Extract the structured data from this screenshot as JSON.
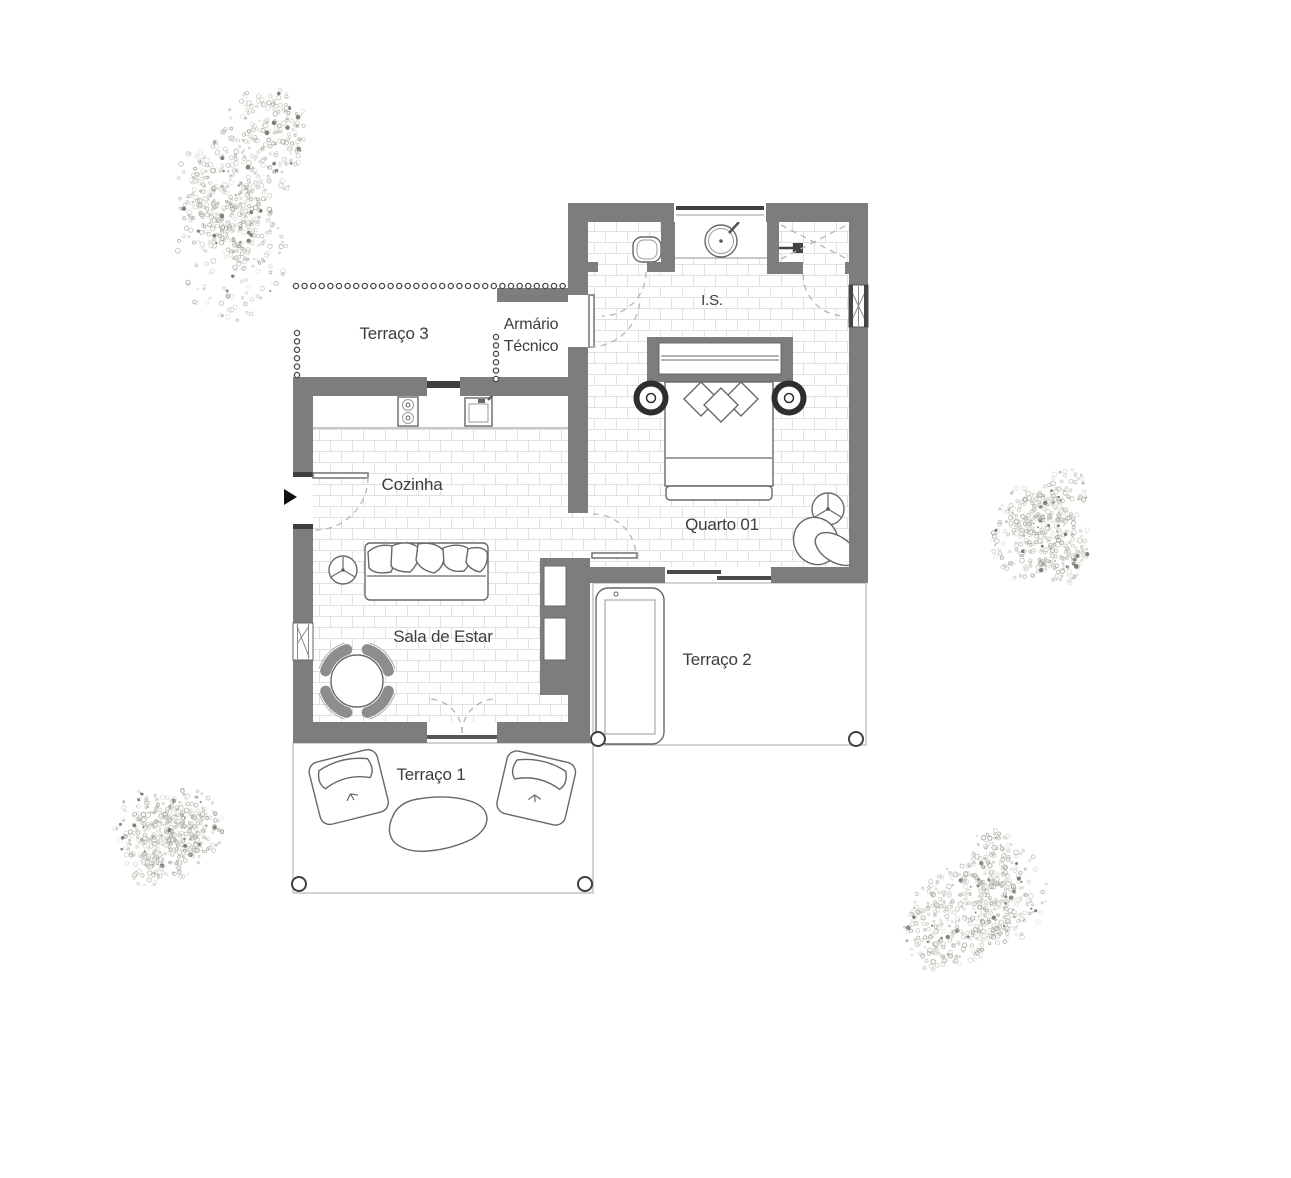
{
  "plan": {
    "type": "architectural-floor-plan",
    "labels": {
      "terraco3": "Terraço 3",
      "armario_line1": "Armário",
      "armario_line2": "Técnico",
      "is": "I.S.",
      "cozinha": "Cozinha",
      "quarto": "Quarto 01",
      "sala": "Sala de Estar",
      "terraco2": "Terraço 2",
      "terraco1": "Terraço 1"
    },
    "colors": {
      "wall": "#7d7d7d",
      "wall_dark": "#3f3f3f",
      "text": "#3d3d3d",
      "tile_brick": "#e0e0e0",
      "tile_grid": "#d2d2ce",
      "tree": "#a3a896",
      "background": "#ffffff"
    },
    "open_boundary_dots": [
      {
        "x": 296,
        "y": 286,
        "dx": 8.6,
        "dy": 0,
        "count": 32
      },
      {
        "x": 297,
        "y": 333,
        "dx": 0,
        "dy": 8.4,
        "count": 6
      },
      {
        "x": 496,
        "y": 337,
        "dx": 0,
        "dy": 8.4,
        "count": 6
      }
    ],
    "vegetation": [
      {
        "name": "tree-top-left",
        "cx": 230,
        "cy": 198,
        "r": 92,
        "stretch_y": 1.3,
        "seed": 11
      },
      {
        "name": "tree-mid-right",
        "cx": 1036,
        "cy": 537,
        "r": 60,
        "stretch_y": 1.15,
        "seed": 22
      },
      {
        "name": "tree-bottom-left",
        "cx": 173,
        "cy": 820,
        "r": 60,
        "stretch_y": 1.2,
        "seed": 33
      },
      {
        "name": "tree-bottom-right",
        "cx": 963,
        "cy": 898,
        "r": 78,
        "stretch_y": 1.15,
        "seed": 44
      }
    ]
  }
}
